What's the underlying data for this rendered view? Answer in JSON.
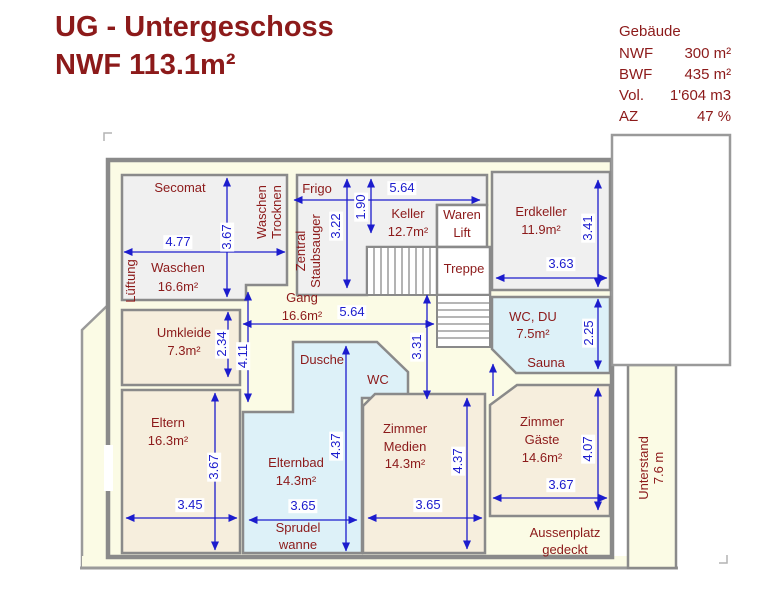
{
  "title": {
    "line1": "UG - Untergeschoss",
    "line2": "NWF 113.1m²"
  },
  "info": {
    "heading": "Gebäude",
    "rows": [
      {
        "label": "NWF",
        "value": "300 m²"
      },
      {
        "label": "BWF",
        "value": "435 m²"
      },
      {
        "label": "Vol.",
        "value": "1'604 m3"
      },
      {
        "label": "AZ",
        "value": "47 %"
      }
    ]
  },
  "colors": {
    "accent_maroon": "#8c1a1a",
    "dimension_blue": "#1c1ccd",
    "wall_gray": "#8a8a8a",
    "plan_cream": "#fbfbe5",
    "room_gray": "#f0f0f0",
    "room_beige": "#f6eedd",
    "room_bath_blue": "#ddf1f8"
  },
  "plan": {
    "rooms": [
      "Waschen",
      "Frigo/Keller",
      "Erdkeller",
      "WC, DU / Sauna",
      "Gang",
      "Umkleide",
      "Eltern",
      "Dusche/WC/Elternbad",
      "Zimmer Medien",
      "Zimmer Gäste",
      "Treppe",
      "Waren Lift",
      "Unterstand",
      "Aussenplatz gedeckt"
    ],
    "labels": [
      {
        "name": "room-label-secomat",
        "text": "Secomat",
        "x": 180,
        "y": 188,
        "cls": "room"
      },
      {
        "name": "dim-waschen-width",
        "text": "4.77",
        "x": 178,
        "y": 242,
        "cls": "dim"
      },
      {
        "name": "dim-waschen-height",
        "text": "3.67",
        "x": 227,
        "y": 237,
        "cls": "dim",
        "rot": 1
      },
      {
        "name": "room-label-waschen",
        "text": "Waschen",
        "x": 178,
        "y": 268,
        "cls": "room"
      },
      {
        "name": "room-area-waschen",
        "text": "16.6m²",
        "x": 178,
        "y": 287,
        "cls": "room"
      },
      {
        "name": "room-label-lueftung",
        "text": "Lüftung",
        "x": 131,
        "y": 281,
        "cls": "room",
        "rot": 1
      },
      {
        "name": "room-label-waschen-trocknen-1",
        "text": "Waschen",
        "x": 262,
        "y": 212,
        "cls": "room",
        "rot": 1
      },
      {
        "name": "room-label-waschen-trocknen-2",
        "text": "Trocknen",
        "x": 277,
        "y": 212,
        "cls": "room",
        "rot": 1
      },
      {
        "name": "room-label-frigo",
        "text": "Frigo",
        "x": 317,
        "y": 189,
        "cls": "room"
      },
      {
        "name": "room-label-zentral-staubsauger-1",
        "text": "Zentral",
        "x": 301,
        "y": 251,
        "cls": "room",
        "rot": 1
      },
      {
        "name": "room-label-zentral-staubsauger-2",
        "text": "Staubsauger",
        "x": 316,
        "y": 251,
        "cls": "room",
        "rot": 1
      },
      {
        "name": "dim-frigo-height",
        "text": "3.22",
        "x": 336,
        "y": 226,
        "cls": "dim",
        "rot": 1
      },
      {
        "name": "dim-frigo-depth",
        "text": "1.90",
        "x": 361,
        "y": 207,
        "cls": "dim",
        "rot": 1
      },
      {
        "name": "dim-keller-width",
        "text": "5.64",
        "x": 402,
        "y": 188,
        "cls": "dim"
      },
      {
        "name": "room-label-keller",
        "text": "Keller",
        "x": 408,
        "y": 214,
        "cls": "room"
      },
      {
        "name": "room-area-keller",
        "text": "12.7m²",
        "x": 408,
        "y": 232,
        "cls": "room"
      },
      {
        "name": "room-label-waren",
        "text": "Waren",
        "x": 462,
        "y": 215,
        "cls": "room"
      },
      {
        "name": "room-label-lift",
        "text": "Lift",
        "x": 462,
        "y": 233,
        "cls": "room"
      },
      {
        "name": "room-label-treppe",
        "text": "Treppe",
        "x": 464,
        "y": 269,
        "cls": "room"
      },
      {
        "name": "room-label-erdkeller",
        "text": "Erdkeller",
        "x": 541,
        "y": 212,
        "cls": "room"
      },
      {
        "name": "room-area-erdkeller",
        "text": "11.9m²",
        "x": 541,
        "y": 230,
        "cls": "room"
      },
      {
        "name": "dim-erdkeller-height",
        "text": "3.41",
        "x": 588,
        "y": 228,
        "cls": "dim",
        "rot": 1
      },
      {
        "name": "dim-erdkeller-width",
        "text": "3.63",
        "x": 561,
        "y": 264,
        "cls": "dim"
      },
      {
        "name": "room-label-gang",
        "text": "Gang",
        "x": 302,
        "y": 298,
        "cls": "room"
      },
      {
        "name": "room-area-gang",
        "text": "16.6m²",
        "x": 302,
        "y": 316,
        "cls": "room"
      },
      {
        "name": "dim-gang-width",
        "text": "5.64",
        "x": 352,
        "y": 312,
        "cls": "dim"
      },
      {
        "name": "room-label-wc-du",
        "text": "WC, DU",
        "x": 533,
        "y": 317,
        "cls": "room"
      },
      {
        "name": "room-area-wc-du",
        "text": "7.5m²",
        "x": 533,
        "y": 334,
        "cls": "room"
      },
      {
        "name": "dim-wc-du-height",
        "text": "2.25",
        "x": 589,
        "y": 333,
        "cls": "dim",
        "rot": 1
      },
      {
        "name": "room-label-sauna",
        "text": "Sauna",
        "x": 546,
        "y": 363,
        "cls": "room"
      },
      {
        "name": "room-label-umkleide",
        "text": "Umkleide",
        "x": 184,
        "y": 333,
        "cls": "room"
      },
      {
        "name": "room-area-umkleide",
        "text": "7.3m²",
        "x": 184,
        "y": 351,
        "cls": "room"
      },
      {
        "name": "dim-umkleide-height",
        "text": "2.34",
        "x": 222,
        "y": 344,
        "cls": "dim",
        "rot": 1
      },
      {
        "name": "dim-gang-height-left",
        "text": "4.11",
        "x": 243,
        "y": 356,
        "cls": "dim",
        "rot": 1
      },
      {
        "name": "dim-gang-height-right",
        "text": "3.31",
        "x": 417,
        "y": 347,
        "cls": "dim",
        "rot": 1
      },
      {
        "name": "room-label-dusche",
        "text": "Dusche",
        "x": 322,
        "y": 360,
        "cls": "room"
      },
      {
        "name": "room-label-wc",
        "text": "WC",
        "x": 378,
        "y": 380,
        "cls": "room"
      },
      {
        "name": "room-label-eltern",
        "text": "Eltern",
        "x": 168,
        "y": 423,
        "cls": "room"
      },
      {
        "name": "room-area-eltern",
        "text": "16.3m²",
        "x": 168,
        "y": 441,
        "cls": "room"
      },
      {
        "name": "dim-eltern-height",
        "text": "3.67",
        "x": 214,
        "y": 467,
        "cls": "dim",
        "rot": 1
      },
      {
        "name": "dim-eltern-width",
        "text": "3.45",
        "x": 190,
        "y": 505,
        "cls": "dim"
      },
      {
        "name": "room-label-elternbad",
        "text": "Elternbad",
        "x": 296,
        "y": 463,
        "cls": "room"
      },
      {
        "name": "room-area-elternbad",
        "text": "14.3m²",
        "x": 296,
        "y": 481,
        "cls": "room"
      },
      {
        "name": "dim-elternbad-height",
        "text": "4.37",
        "x": 336,
        "y": 446,
        "cls": "dim",
        "rot": 1
      },
      {
        "name": "dim-elternbad-width",
        "text": "3.65",
        "x": 303,
        "y": 506,
        "cls": "dim"
      },
      {
        "name": "room-label-sprudelwanne-1",
        "text": "Sprudel",
        "x": 298,
        "y": 528,
        "cls": "room"
      },
      {
        "name": "room-label-sprudelwanne-2",
        "text": "wanne",
        "x": 298,
        "y": 545,
        "cls": "room"
      },
      {
        "name": "room-label-zimmer-medien-1",
        "text": "Zimmer",
        "x": 405,
        "y": 429,
        "cls": "room"
      },
      {
        "name": "room-label-zimmer-medien-2",
        "text": "Medien",
        "x": 405,
        "y": 447,
        "cls": "room"
      },
      {
        "name": "room-area-zimmer-medien",
        "text": "14.3m²",
        "x": 405,
        "y": 464,
        "cls": "room"
      },
      {
        "name": "dim-zimmer-medien-height",
        "text": "4.37",
        "x": 458,
        "y": 461,
        "cls": "dim",
        "rot": 1
      },
      {
        "name": "dim-zimmer-medien-width",
        "text": "3.65",
        "x": 428,
        "y": 505,
        "cls": "dim"
      },
      {
        "name": "room-label-zimmer-gaeste-1",
        "text": "Zimmer",
        "x": 542,
        "y": 422,
        "cls": "room"
      },
      {
        "name": "room-label-zimmer-gaeste-2",
        "text": "Gäste",
        "x": 542,
        "y": 440,
        "cls": "room"
      },
      {
        "name": "room-area-zimmer-gaeste",
        "text": "14.6m²",
        "x": 542,
        "y": 458,
        "cls": "room"
      },
      {
        "name": "dim-zimmer-gaeste-height",
        "text": "4.07",
        "x": 588,
        "y": 449,
        "cls": "dim",
        "rot": 1
      },
      {
        "name": "dim-zimmer-gaeste-width",
        "text": "3.67",
        "x": 561,
        "y": 485,
        "cls": "dim"
      },
      {
        "name": "label-aussenplatz-1",
        "text": "Aussenplatz",
        "x": 565,
        "y": 533,
        "cls": "room"
      },
      {
        "name": "label-aussenplatz-2",
        "text": "gedeckt",
        "x": 565,
        "y": 550,
        "cls": "room"
      },
      {
        "name": "label-unterstand-1",
        "text": "Unterstand",
        "x": 644,
        "y": 468,
        "cls": "room",
        "rot": 1
      },
      {
        "name": "label-unterstand-2",
        "text": "7.6 m",
        "x": 659,
        "y": 468,
        "cls": "room",
        "rot": 1
      }
    ]
  }
}
